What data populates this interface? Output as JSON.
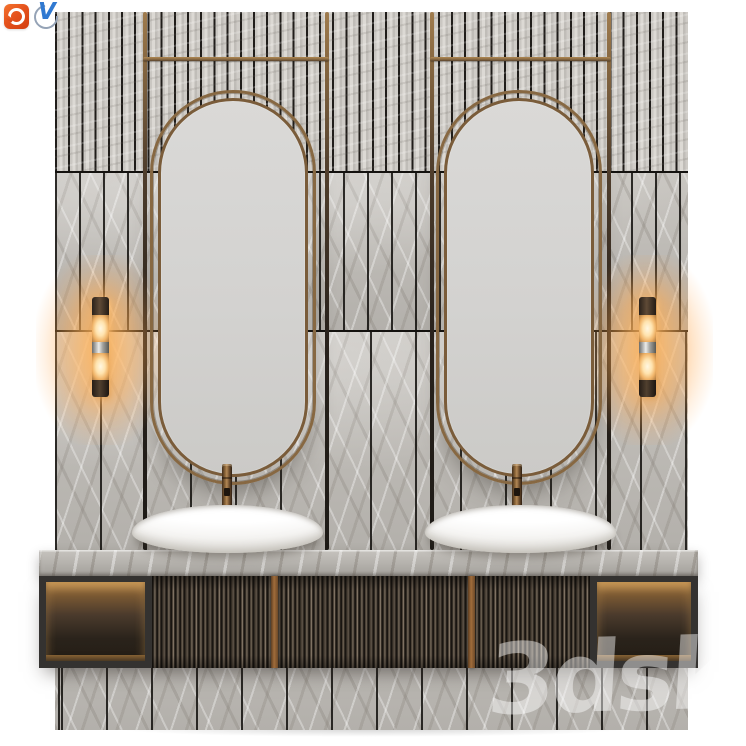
{
  "scene": {
    "type": "3d-product-render",
    "subject": "Double bathroom vanity set: slatted stone wall, two oval brass-framed mirrors on hanging rods, two white oval vessel sinks with bronze faucets, marble countertop, fluted dark-wood cabinet with two back-lit niches and two cylindrical wall sconces",
    "watermark": {
      "text": "3dsky",
      "color": "#ffffff",
      "opacity": 0.45
    },
    "badges": [
      {
        "name": "corona-renderer-icon",
        "shape": "rounded-square",
        "color": "#e0511f"
      },
      {
        "name": "v-ray-icon",
        "shape": "open-circle",
        "glyph": "V",
        "color": "#3079d1"
      }
    ],
    "palette": {
      "background": "#ffffff",
      "wall_stone": "#c6c3be",
      "tile_seam": "#1b1916",
      "brass": "#8a6a42",
      "mirror_glass": "#d6d5d3",
      "sink_ceramic": "#fbfbfa",
      "fluted_wood": "#3e362d",
      "niche_glow": "#a97e45",
      "countertop_marble": "#b2afaa",
      "sconce_light": "#ffd9a0"
    },
    "elements": {
      "mirrors": 2,
      "vessel_sinks": 2,
      "faucets": 2,
      "wall_sconces": 2,
      "lit_niches": 2,
      "brass_rods_vertical": 4,
      "brass_rods_horizontal": 2,
      "wall_bands": [
        "narrow vertical slats",
        "medium vertical tiles",
        "wide vertical tiles",
        "base tiles below cabinet"
      ]
    }
  }
}
